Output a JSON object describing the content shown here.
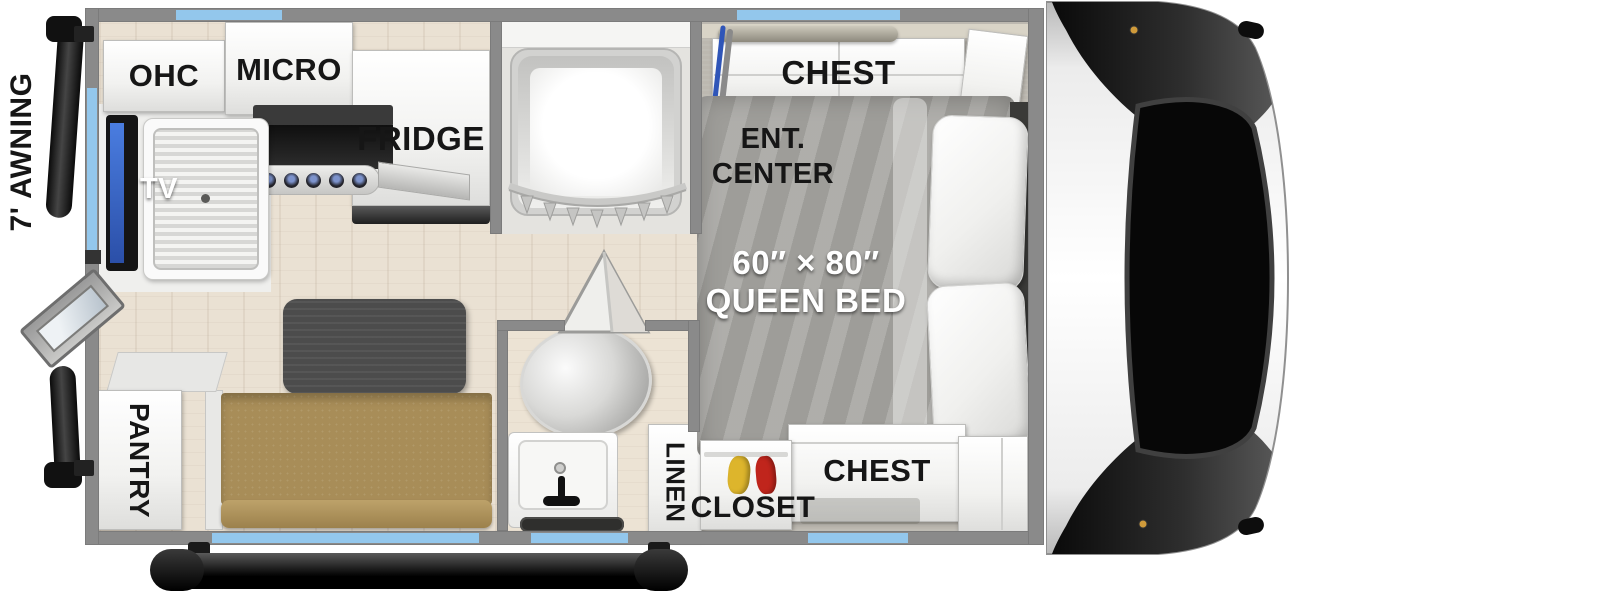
{
  "colors": {
    "wall": "#8a8a8a",
    "window_accent": "#93c7ec",
    "wood_floor": "#eae1d3",
    "carpet": "#bcb8b0",
    "sofa": "#a88d58",
    "table": "#4c4c4c",
    "bed_fabric": "#a6a5a1",
    "tv_screen": "#3a6cd8",
    "label_text": "#161616"
  },
  "exterior": {
    "awning_label": "7' AWNING"
  },
  "kitchen": {
    "ohc_label": "OHC",
    "micro_label": "MICRO",
    "fridge_label": "FRIDGE",
    "tv_label": "TV",
    "pantry_label": "PANTRY"
  },
  "bathroom": {
    "linen_label": "LINEN"
  },
  "bedroom": {
    "chest_top_label": "CHEST",
    "ent_center_label_line1": "ENT.",
    "ent_center_label_line2": "CENTER",
    "bed_size_label": "60″ × 80″",
    "bed_type_label": "QUEEN BED",
    "closet_label": "CLOSET",
    "chest_bottom_label": "CHEST"
  }
}
